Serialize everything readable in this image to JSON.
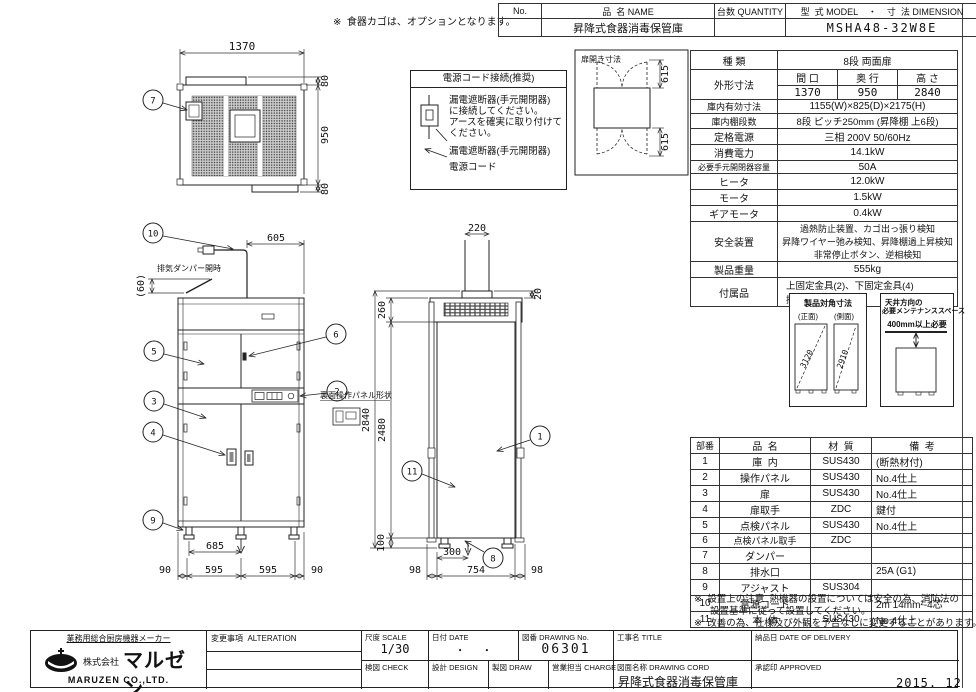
{
  "sheet": {
    "date_code": "2015. 12"
  },
  "top_note": "※  食器カゴは、オプションとなります。",
  "header_table": {
    "col_no": "No.",
    "col_name": "品  名 NAME",
    "col_qty": "台数 QUANTITY",
    "col_model": "型  式 MODEL    ・    寸  法 DIMENSION",
    "name_value": "昇降式食器消毒保管庫",
    "model_value": "MSHA48-32W8E"
  },
  "spec": {
    "r0": {
      "label": "種  類",
      "value": "8段  両面扉"
    },
    "size": {
      "label": "外形寸法",
      "c1": "間 口",
      "c2": "奥 行",
      "c3": "高 さ",
      "v1": "1370",
      "v2": "950",
      "v3": "2840"
    },
    "r2": {
      "label": "庫内有効寸法",
      "value": "1155(W)×825(D)×2175(H)"
    },
    "r3": {
      "label": "庫内棚段数",
      "value": "8段 ピッチ250mm (昇降棚 上6段)"
    },
    "r4": {
      "label": "定格電源",
      "value": "三相 200V 50/60Hz"
    },
    "r5": {
      "label": "消費電力",
      "value": "14.1kW"
    },
    "r6": {
      "label": "必要手元開閉器容量",
      "value": "50A"
    },
    "r7": {
      "label": "ヒータ",
      "value": "12.0kW"
    },
    "r8": {
      "label": "モータ",
      "value": "1.5kW"
    },
    "r9": {
      "label": "ギアモータ",
      "value": "0.4kW"
    },
    "safety": {
      "label": "安全装置",
      "l1": "過熱防止装置、カゴ出っ張り検知",
      "l2": "昇降ワイヤー弛み検知、昇降棚過上昇検知",
      "l3": "非常停止ボタン、逆相検知"
    },
    "r11": {
      "label": "製品重量",
      "value": "555kg"
    },
    "acc": {
      "label": "付属品",
      "l1": "上固定金具(2)、下固定金具(4)",
      "l2": "接続金具(2)"
    }
  },
  "power_box": {
    "title": "電源コード接続(推奨)",
    "body1": "漏電遮断器(手元開閉器)",
    "body2": "に接続してください。",
    "body3": "アースを確実に取り付けて",
    "body4": "ください。",
    "label1": "漏電遮断器(手元開閉器)",
    "label2": "電源コード"
  },
  "door_diagram": {
    "title": "扉開き寸法",
    "dim_top": "615",
    "dim_bottom": "615"
  },
  "diag_box": {
    "title": "製品対角寸法",
    "front_label": "(正面)",
    "side_label": "(側面)",
    "front_value": "3120",
    "side_value": "2910"
  },
  "maint_box": {
    "title1": "天井方向の",
    "title2": "必要メンテナンススペース",
    "requirement": "400mm以上必要"
  },
  "drawing": {
    "rear_panel_label": "裏面操作パネル形状",
    "exhaust_label": "排気ダンパー開時",
    "dims": {
      "w": "1370",
      "d": "950",
      "m1": "80",
      "m2": "80",
      "cord": "605",
      "exh": "(60)",
      "drain_x": "685",
      "f1": "90",
      "f2": "595",
      "f3": "595",
      "f4": "90",
      "duct": "220",
      "duct_h": "20",
      "top_h": "260",
      "total": "2840",
      "body": "2480",
      "leg": "100",
      "drain_y": "300",
      "s1": "98",
      "s2": "754",
      "s3": "98"
    },
    "balloons": {
      "b1": "1",
      "b2": "2",
      "b3": "3",
      "b4": "4",
      "b5": "5",
      "b6": "6",
      "b7": "7",
      "b8": "8",
      "b9": "9",
      "b10": "10",
      "b11": "11"
    }
  },
  "parts": {
    "headers": {
      "no": "部番",
      "name": "品  名",
      "material": "材  質",
      "note": "備  考"
    },
    "rows": [
      {
        "no": "1",
        "name": "庫  内",
        "mat": "SUS430",
        "note": "(断熱材付)"
      },
      {
        "no": "2",
        "name": "操作パネル",
        "mat": "SUS430",
        "note": "No.4仕上"
      },
      {
        "no": "3",
        "name": "扉",
        "mat": "SUS430",
        "note": "No.4仕上"
      },
      {
        "no": "4",
        "name": "扉取手",
        "mat": "ZDC",
        "note": "鍵付"
      },
      {
        "no": "5",
        "name": "点検パネル",
        "mat": "SUS430",
        "note": "No.4仕上"
      },
      {
        "no": "6",
        "name": "点検パネル取手",
        "mat": "ZDC",
        "note": ""
      },
      {
        "no": "7",
        "name": "ダンパー",
        "mat": "",
        "note": ""
      },
      {
        "no": "8",
        "name": "排水口",
        "mat": "",
        "note": "25A (G1)"
      },
      {
        "no": "9",
        "name": "アジャスト",
        "mat": "SUS304",
        "note": ""
      },
      {
        "no": "10",
        "name": "電源コード",
        "mat": "",
        "note": "2m 14mm²-4芯"
      },
      {
        "no": "11",
        "name": "本  体",
        "mat": "SUS430",
        "note": "No.4仕上"
      }
    ]
  },
  "notes": {
    "line1": "※  設置上の注意  熱機器の設置については安全の為、消防法の",
    "line2": "設置基準に従って設置してください。",
    "line3": "※  改善の為、仕様及び外観を予告なしに変更することがあります。"
  },
  "titleblock": {
    "maker_tagline": "業務用総合厨房機器メーカー",
    "company_prefix": "株式会社",
    "company_logo": "マルゼン",
    "company_en": "MARUZEN  CO.,LTD.",
    "alteration": "変更事項  ALTERATION",
    "scale_label": "尺度 SCALE",
    "scale_value": "1/30",
    "date_label": "日付 DATE",
    "date_value": "・      ・",
    "dwgno_label": "図番 DRAWING No.",
    "dwgno_value": "06301",
    "title_label": "工事名 TITLE",
    "check_label": "検図 CHECK",
    "design_label": "設計 DESIGN",
    "draw_label": "製図 DRAW",
    "charge_label": "営業担当 CHARGE",
    "dwgname_label": "図面名称 DRAWING CORD",
    "dwgname_value": "昇降式食器消毒保管庫",
    "delivery_label": "納品日 DATE OF DELIVERY",
    "approved_label": "承認印 APPROVED"
  }
}
